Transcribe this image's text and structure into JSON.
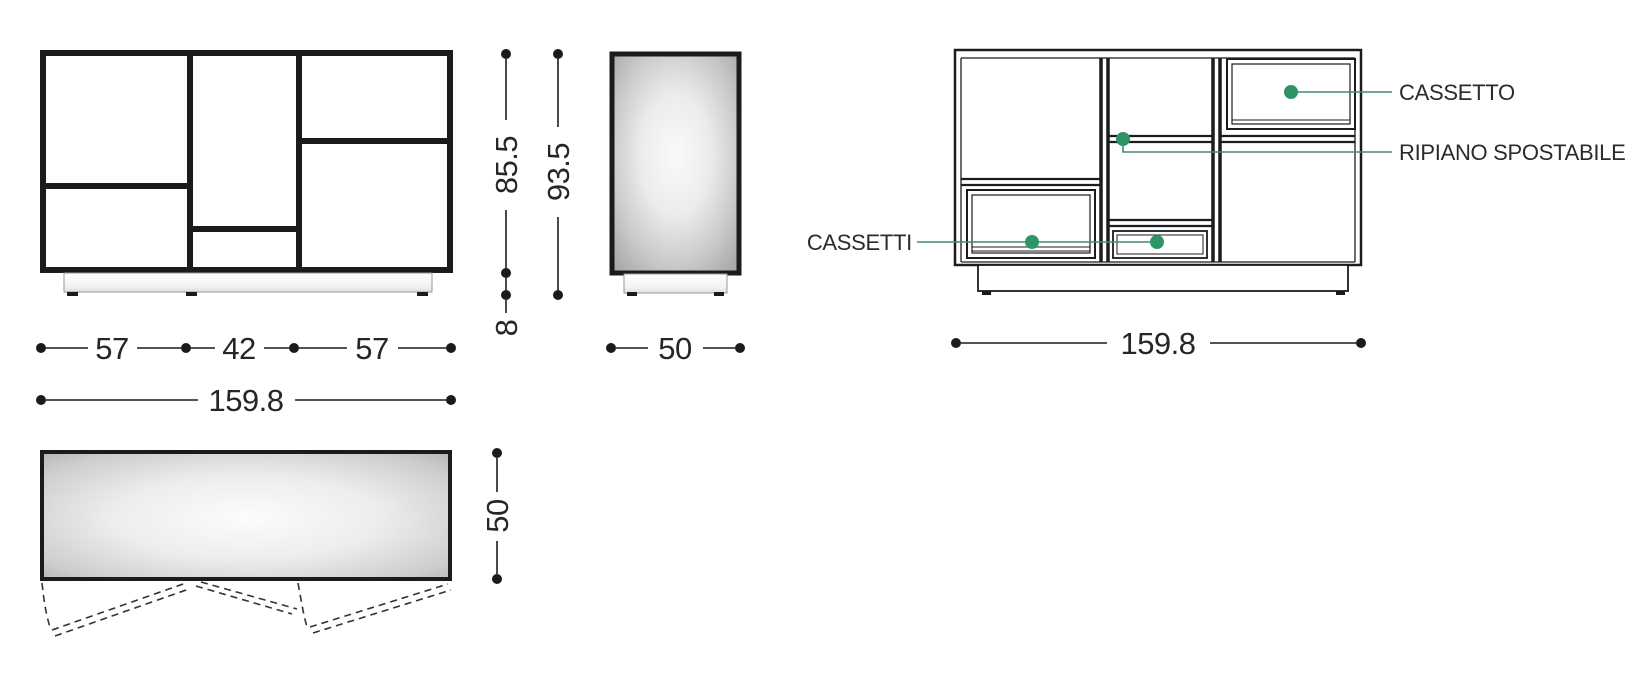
{
  "drawing": {
    "type": "furniture-technical-drawing",
    "subject": "sideboard with drawers and movable shelf",
    "dims": {
      "w_left": "57",
      "w_mid": "42",
      "w_right": "57",
      "total_width": "159.8",
      "body_height": "85.5",
      "total_height": "93.5",
      "plinth_height": "8",
      "depth": "50"
    },
    "labels": {
      "cassetto": "CASSETTO",
      "ripiano": "RIPIANO SPOSTABILE",
      "cassetti": "CASSETTI"
    },
    "colors": {
      "line": "#1b1b1b",
      "leader": "#47877a",
      "marker": "#2e9466",
      "text": "#262626"
    }
  }
}
